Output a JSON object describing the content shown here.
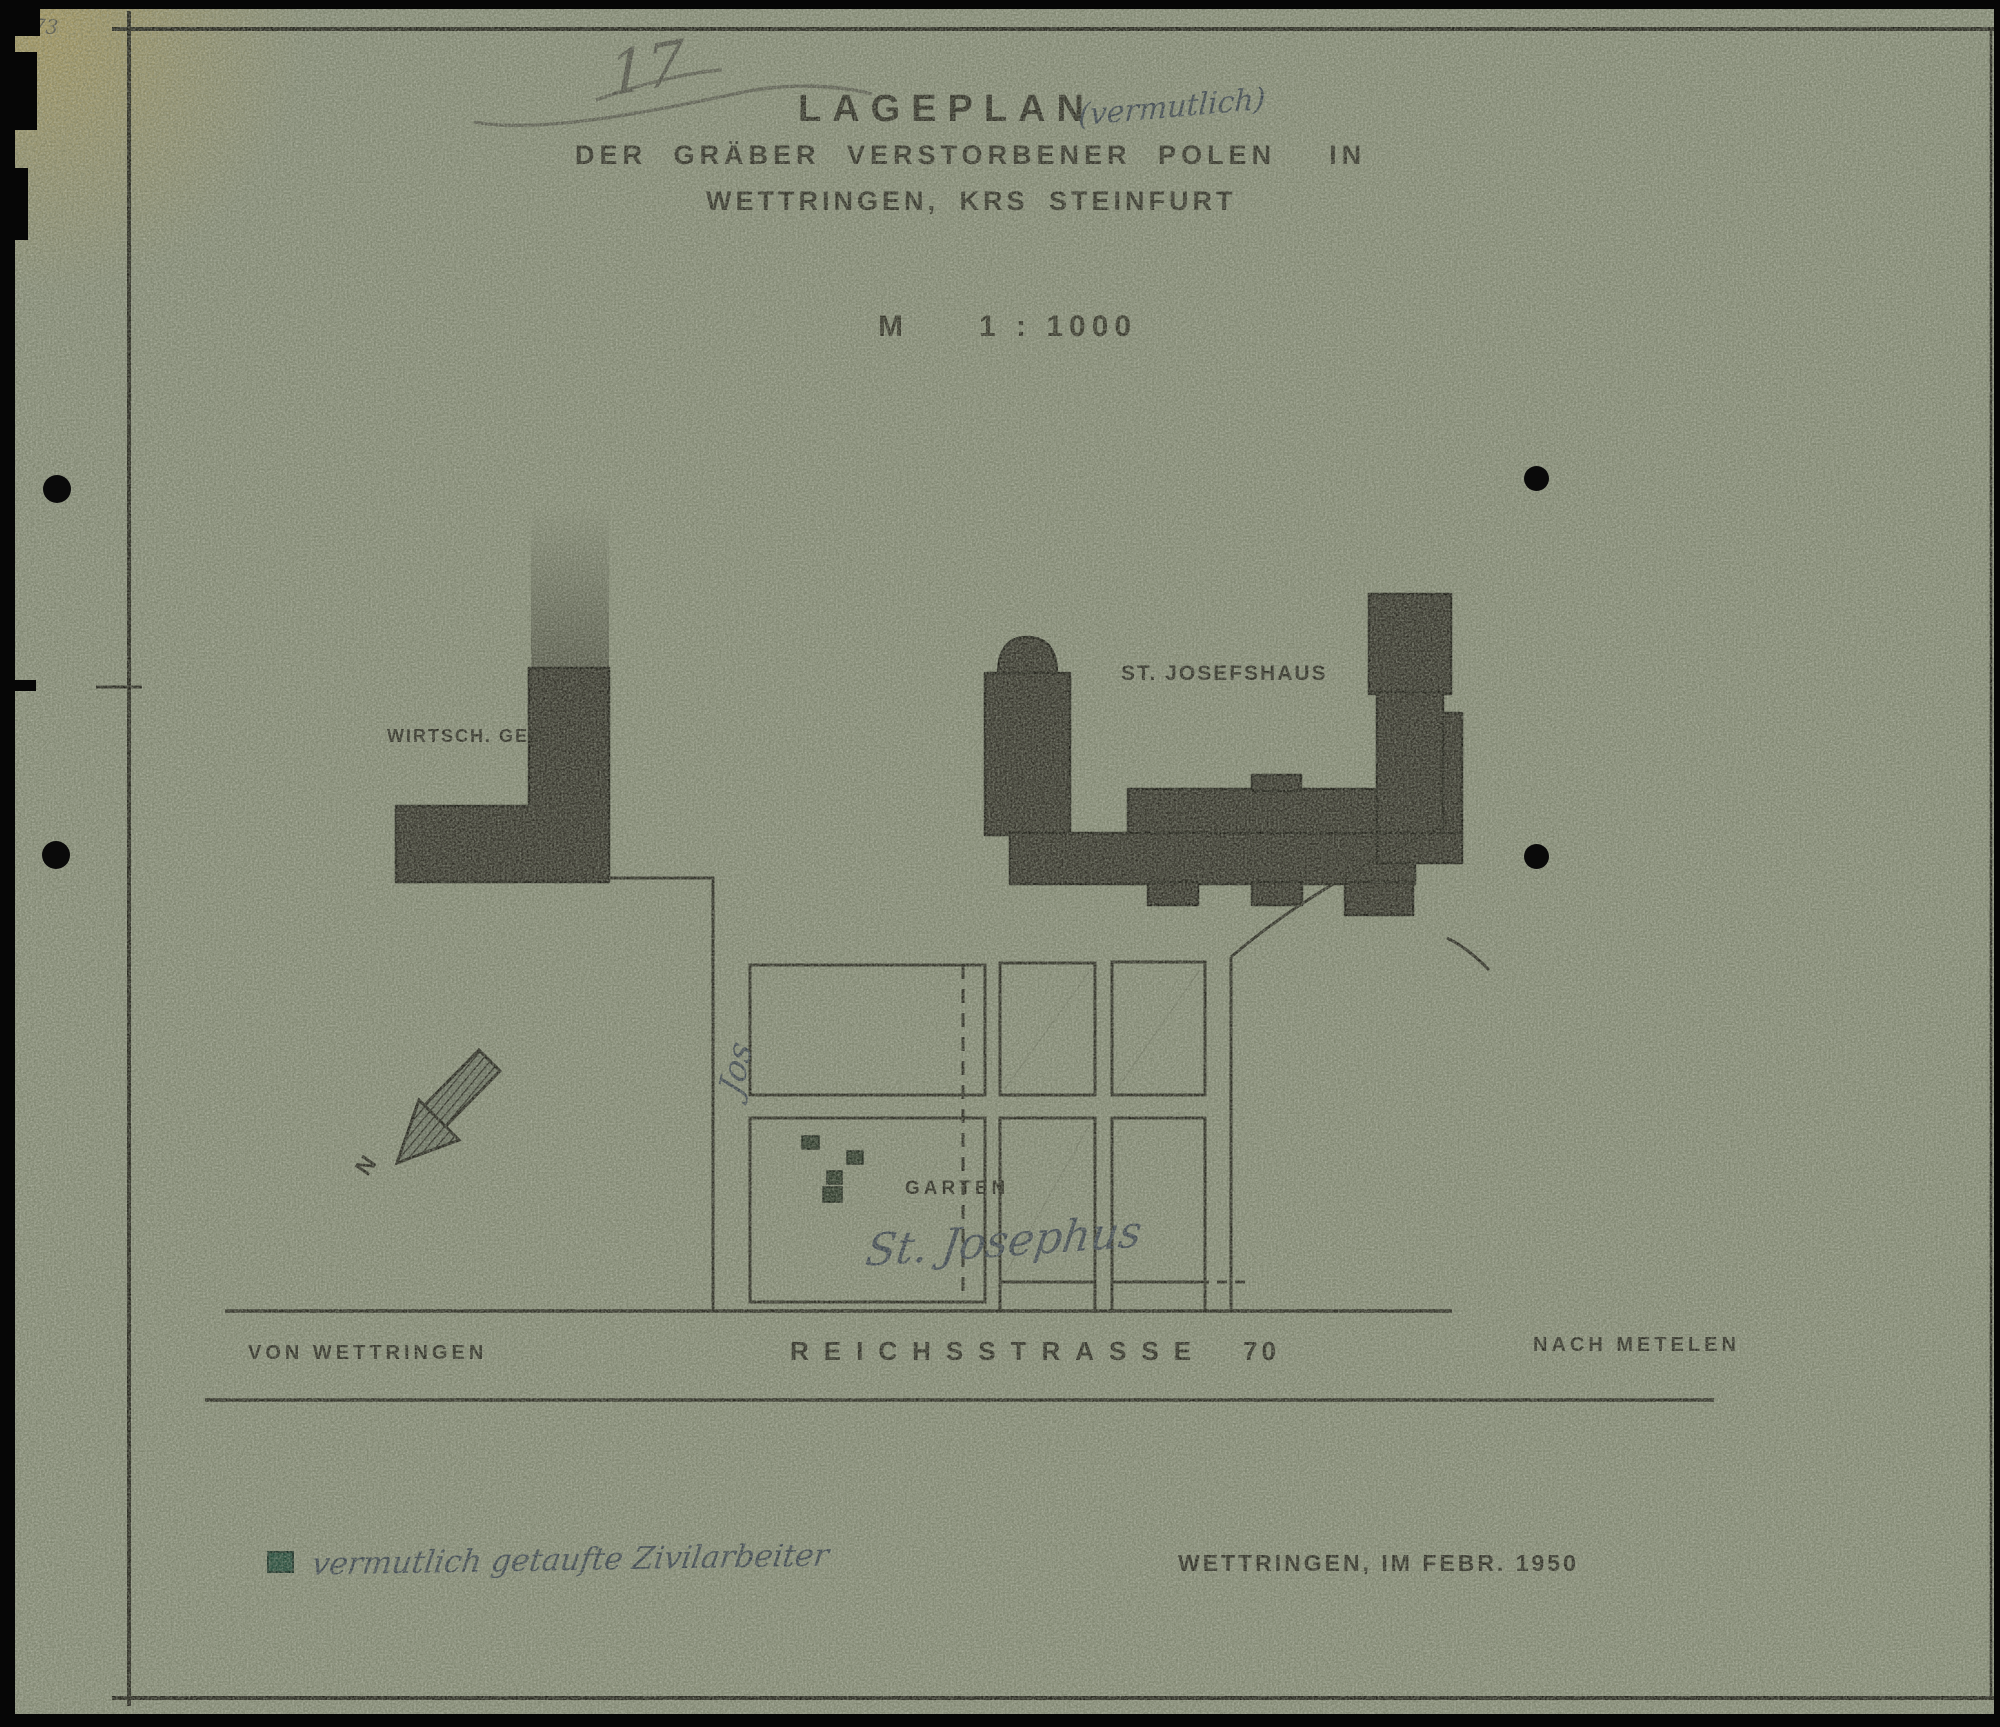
{
  "page": {
    "archive_number": "473",
    "sheet_number": "17"
  },
  "title": {
    "main": "LAGEPLAN",
    "handwritten_annotation": "(vermutlich)",
    "line2": "DER GRÄBER VERSTORBENER POLEN  IN",
    "line3": "WETTRINGEN, KRS STEINFURT",
    "scale_label": "M",
    "scale_value": "1 : 1000"
  },
  "map": {
    "building_left_label": "WIRTSCH. GEB.",
    "building_right_label": "ST. JOSEFSHAUS",
    "garden_label": "GARTEN",
    "garden_handwritten": "St. Josephus",
    "vertical_scribble": "Jos",
    "north_label": "N",
    "road_from": "VON WETTRINGEN",
    "road_name": "REICHSSTRASSE",
    "road_number": "70",
    "road_to": "NACH METELEN",
    "grave_marker_count": 4
  },
  "legend": {
    "marker": "green-square",
    "text": "vermutlich getaufte Zivilarbeiter"
  },
  "footer": {
    "date_line": "WETTRINGEN, IM FEBR. 1950"
  },
  "colors": {
    "paper": "#8b917c",
    "ink": "#23221b",
    "pencil": "#4f4f47",
    "blue_ink": "#39424f",
    "legend_green": "#1d4737",
    "grave_green": "#243123",
    "building_fill": "#2d2b24",
    "stain_yellow": "#c4a042"
  }
}
